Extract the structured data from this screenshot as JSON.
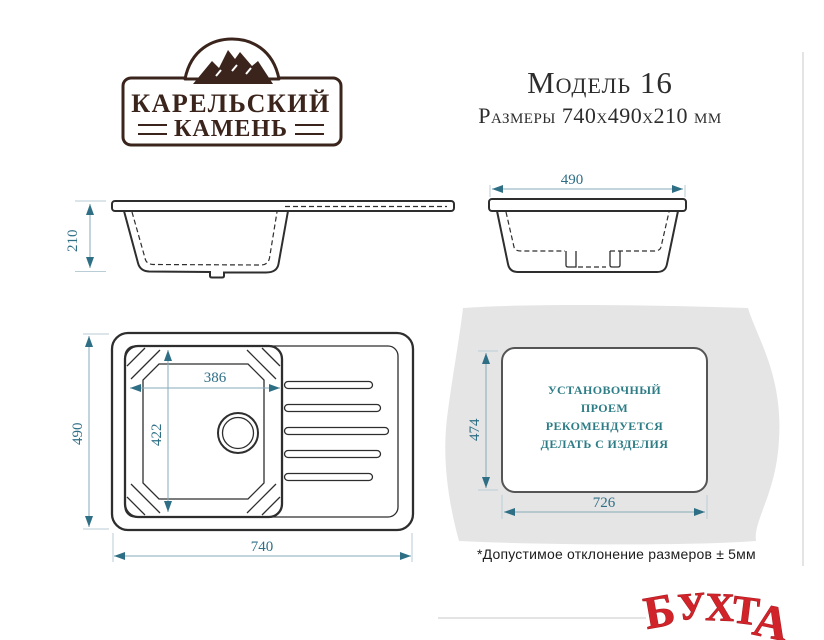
{
  "brand": {
    "line1": "КАРЕЛЬСКИЙ",
    "line2": "КАМЕНЬ"
  },
  "header": {
    "model": "Модель 16",
    "dimensions": "Размеры 740х490х210 мм"
  },
  "views": {
    "side": {
      "height": "210"
    },
    "front": {
      "width": "490"
    },
    "top": {
      "bowl_width": "386",
      "bowl_depth": "422",
      "length": "740",
      "width": "490"
    },
    "cutout": {
      "depth": "474",
      "width": "726",
      "note_lines": [
        "УСТАНОВОЧНЫЙ",
        "ПРОЕМ",
        "РЕКОМЕНДУЕТСЯ",
        "ДЕЛАТЬ С ИЗДЕЛИЯ"
      ]
    }
  },
  "footnote": "*Допустимое отклонение размеров ± 5мм",
  "watermark": {
    "word": "БУХТА",
    "letters": [
      "Б",
      "У",
      "Х",
      "Т",
      "А"
    ]
  },
  "colors": {
    "dimension_text": "#2e6f86",
    "drawing_line": "#2e2e2e",
    "brand_brown": "#3a241c",
    "watermark_red": "#d1232a",
    "countertop_gray": "#e5e5e5",
    "cutout_text_teal": "#2e7d86"
  }
}
